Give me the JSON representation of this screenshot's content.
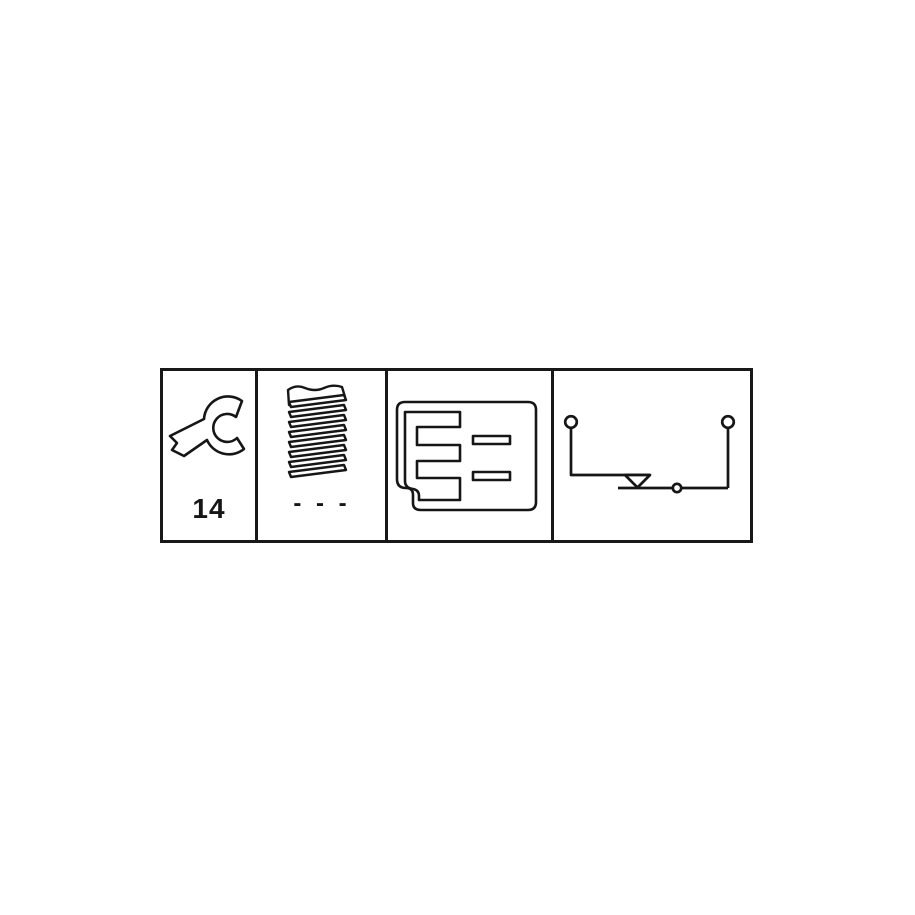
{
  "page": {
    "background": "#ffffff",
    "line_color": "#181818"
  },
  "strip": {
    "description": "four-panel technical specification pictogram strip",
    "panels": [
      {
        "id": "wrench-size",
        "icon": "open-end-wrench-icon",
        "value": "14"
      },
      {
        "id": "thread-size",
        "icon": "screw-thread-icon",
        "value": "- - -"
      },
      {
        "id": "connector-face",
        "icon": "connector-plug-icon"
      },
      {
        "id": "switch-circuit",
        "icon": "switch-circuit-diagram-icon"
      }
    ]
  }
}
